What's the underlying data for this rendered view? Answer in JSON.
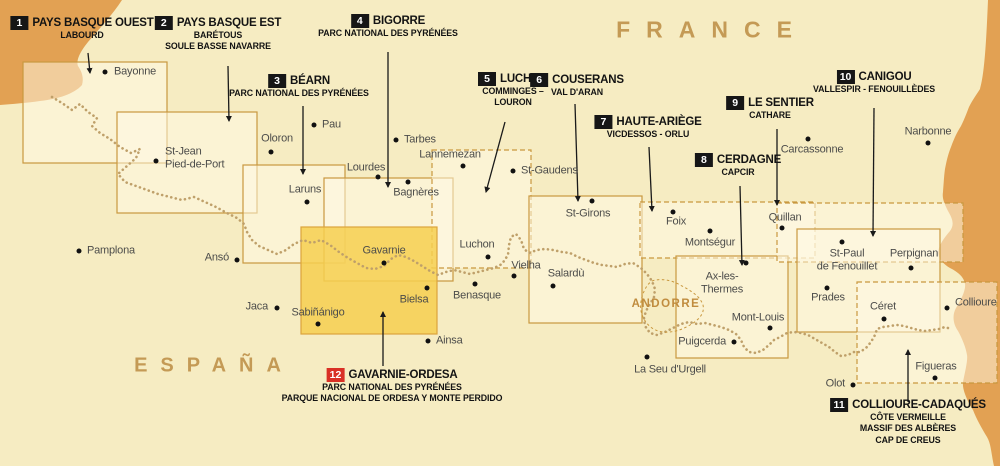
{
  "titles": {
    "france": "FRANCE",
    "espana": "ESPAÑA",
    "andorre": "ANDORRE"
  },
  "colors": {
    "background": "#f6ecc2",
    "sea": "#e2a153",
    "area_border": "#c9983f",
    "area_fill": "rgba(255,250,230,0.5)",
    "highlight_fill": "rgba(246,207,80,0.85)",
    "highlight_border": "#dca43c",
    "trail": "#bfa06a",
    "badge_black": "#161616",
    "badge_red": "#d93025",
    "label_text": "#131313",
    "city_text": "#4c4c4a",
    "region_text": "#c49a55"
  },
  "map_labels": [
    {
      "num": "1",
      "badge": "black",
      "title": "PAYS BASQUE OUEST",
      "subtitle_lines": [
        "LABOURD"
      ],
      "cx": 82,
      "top": 16,
      "arrow": [
        88,
        53,
        90,
        73
      ]
    },
    {
      "num": "2",
      "badge": "black",
      "title": "PAYS BASQUE EST",
      "subtitle_lines": [
        "BARÉTOUS",
        "SOULE BASSE NAVARRE"
      ],
      "cx": 218,
      "top": 16,
      "arrow": [
        228,
        66,
        229,
        121
      ]
    },
    {
      "num": "3",
      "badge": "black",
      "title": "BÉARN",
      "subtitle_lines": [
        "PARC NATIONAL DES PYRÉNÉES"
      ],
      "cx": 299,
      "top": 74,
      "arrow": [
        303,
        106,
        303,
        174
      ]
    },
    {
      "num": "4",
      "badge": "black",
      "title": "BIGORRE",
      "subtitle_lines": [
        "PARC NATIONAL DES PYRÉNÉES"
      ],
      "cx": 388,
      "top": 14,
      "arrow": [
        388,
        52,
        388,
        187
      ]
    },
    {
      "num": "5",
      "badge": "black",
      "title": "LUCHON",
      "subtitle_lines": [
        "COMMINGES –",
        "LOURON"
      ],
      "cx": 513,
      "top": 72,
      "arrow": [
        505,
        122,
        486,
        192
      ]
    },
    {
      "num": "6",
      "badge": "black",
      "title": "COUSERANS",
      "subtitle_lines": [
        "VAL D'ARAN"
      ],
      "cx": 577,
      "top": 73,
      "arrow": [
        575,
        104,
        578,
        201
      ]
    },
    {
      "num": "7",
      "badge": "black",
      "title": "HAUTE-ARIÈGE",
      "subtitle_lines": [
        "VICDESSOS - ORLU"
      ],
      "cx": 648,
      "top": 115,
      "arrow": [
        649,
        147,
        652,
        211
      ]
    },
    {
      "num": "8",
      "badge": "black",
      "title": "CERDAGNE",
      "subtitle_lines": [
        "CAPCIR"
      ],
      "cx": 738,
      "top": 153,
      "arrow": [
        740,
        186,
        742,
        265
      ]
    },
    {
      "num": "9",
      "badge": "black",
      "title": "LE SENTIER",
      "subtitle_lines": [
        "CATHARE"
      ],
      "cx": 770,
      "top": 96,
      "arrow": [
        777,
        129,
        777,
        205
      ]
    },
    {
      "num": "10",
      "badge": "black",
      "title": "CANIGOU",
      "subtitle_lines": [
        "VALLESPIR - FENOUILLÈDES"
      ],
      "cx": 874,
      "top": 70,
      "arrow": [
        874,
        108,
        873,
        236
      ]
    },
    {
      "num": "11",
      "badge": "black",
      "title": "COLLIOURE-CADAQUÉS",
      "subtitle_lines": [
        "CÔTE VERMEILLE",
        "MASSIF DES ALBÈRES",
        "CAP DE CREUS"
      ],
      "cx": 908,
      "top": 398,
      "arrow": [
        908,
        402,
        908,
        350
      ]
    },
    {
      "num": "12",
      "badge": "red",
      "title": "GAVARNIE-ORDESA",
      "subtitle_lines": [
        "PARC NATIONAL DES PYRÉNÉES",
        "PARQUE NACIONAL DE ORDESA Y MONTE PERDIDO"
      ],
      "cx": 392,
      "top": 368,
      "arrow": [
        383,
        366,
        383,
        312
      ]
    }
  ],
  "areas": [
    {
      "map": "1",
      "rect": [
        23,
        62,
        144,
        101
      ],
      "style": "solid"
    },
    {
      "map": "2",
      "rect": [
        117,
        112,
        140,
        101
      ],
      "style": "solid"
    },
    {
      "map": "3",
      "rect": [
        243,
        165,
        102,
        98
      ],
      "style": "solid"
    },
    {
      "map": "4",
      "rect": [
        324,
        178,
        129,
        103
      ],
      "style": "solid"
    },
    {
      "map": "5",
      "rect": [
        432,
        150,
        99,
        118
      ],
      "style": "dashed"
    },
    {
      "map": "6",
      "rect": [
        529,
        196,
        113,
        127
      ],
      "style": "solid"
    },
    {
      "map": "7",
      "rect": [
        640,
        202,
        175,
        56
      ],
      "style": "dashed"
    },
    {
      "map": "8",
      "rect": [
        676,
        256,
        112,
        102
      ],
      "style": "solid"
    },
    {
      "map": "9",
      "rect": [
        777,
        203,
        186,
        59
      ],
      "style": "dashed"
    },
    {
      "map": "10",
      "rect": [
        797,
        229,
        143,
        103
      ],
      "style": "solid"
    },
    {
      "map": "11",
      "rect": [
        857,
        282,
        140,
        101
      ],
      "style": "dashed"
    },
    {
      "map": "12",
      "rect": [
        301,
        227,
        136,
        107
      ],
      "style": "highlight"
    }
  ],
  "cities": [
    {
      "name": "Bayonne",
      "dot": [
        105,
        72
      ],
      "label": [
        114,
        72
      ],
      "anchor": "left"
    },
    {
      "name": "St-Jean\nPied-de-Port",
      "dot": [
        156,
        161
      ],
      "label": [
        165,
        158
      ],
      "anchor": "left"
    },
    {
      "name": "Oloron",
      "dot": [
        271,
        152
      ],
      "label": [
        277,
        139
      ],
      "anchor": "center"
    },
    {
      "name": "Pau",
      "dot": [
        314,
        125
      ],
      "label": [
        322,
        125
      ],
      "anchor": "left"
    },
    {
      "name": "Laruns",
      "dot": [
        307,
        202
      ],
      "label": [
        305,
        190
      ],
      "anchor": "center"
    },
    {
      "name": "Lourdes",
      "dot": [
        378,
        177
      ],
      "label": [
        366,
        168
      ],
      "anchor": "center"
    },
    {
      "name": "Tarbes",
      "dot": [
        396,
        140
      ],
      "label": [
        404,
        140
      ],
      "anchor": "left"
    },
    {
      "name": "Lannemezan",
      "dot": [
        463,
        166
      ],
      "label": [
        450,
        155
      ],
      "anchor": "center"
    },
    {
      "name": "Bagnères",
      "dot": [
        408,
        182
      ],
      "label": [
        416,
        193
      ],
      "anchor": "center"
    },
    {
      "name": "St-Gaudens",
      "dot": [
        513,
        171
      ],
      "label": [
        521,
        171
      ],
      "anchor": "left"
    },
    {
      "name": "St-Girons",
      "dot": [
        592,
        201
      ],
      "label": [
        588,
        214
      ],
      "anchor": "center"
    },
    {
      "name": "Luchon",
      "dot": [
        488,
        257
      ],
      "label": [
        477,
        245
      ],
      "anchor": "center"
    },
    {
      "name": "Vielha",
      "dot": [
        514,
        276
      ],
      "label": [
        526,
        266
      ],
      "anchor": "center"
    },
    {
      "name": "Salardù",
      "dot": [
        553,
        286
      ],
      "label": [
        566,
        274
      ],
      "anchor": "center"
    },
    {
      "name": "Benasque",
      "dot": [
        475,
        284
      ],
      "label": [
        477,
        296
      ],
      "anchor": "center"
    },
    {
      "name": "Gavarnie",
      "dot": [
        384,
        263
      ],
      "label": [
        384,
        251
      ],
      "anchor": "center"
    },
    {
      "name": "Bielsa",
      "dot": [
        427,
        288
      ],
      "label": [
        414,
        300
      ],
      "anchor": "center"
    },
    {
      "name": "Ainsa",
      "dot": [
        428,
        341
      ],
      "label": [
        436,
        341
      ],
      "anchor": "left"
    },
    {
      "name": "Sabiñánigo",
      "dot": [
        318,
        324
      ],
      "label": [
        318,
        313
      ],
      "anchor": "center"
    },
    {
      "name": "Jaca",
      "dot": [
        277,
        308
      ],
      "label": [
        268,
        307
      ],
      "anchor": "right"
    },
    {
      "name": "Ansó",
      "dot": [
        237,
        260
      ],
      "label": [
        229,
        258
      ],
      "anchor": "right"
    },
    {
      "name": "Pamplona",
      "dot": [
        79,
        251
      ],
      "label": [
        87,
        251
      ],
      "anchor": "left"
    },
    {
      "name": "Foix",
      "dot": [
        673,
        212
      ],
      "label": [
        676,
        222
      ],
      "anchor": "center"
    },
    {
      "name": "Montségur",
      "dot": [
        710,
        231
      ],
      "label": [
        710,
        243
      ],
      "anchor": "center"
    },
    {
      "name": "Quillan",
      "dot": [
        782,
        228
      ],
      "label": [
        785,
        218
      ],
      "anchor": "center"
    },
    {
      "name": "Carcassonne",
      "dot": [
        808,
        139
      ],
      "label": [
        812,
        150
      ],
      "anchor": "center"
    },
    {
      "name": "Narbonne",
      "dot": [
        928,
        143
      ],
      "label": [
        928,
        132
      ],
      "anchor": "center"
    },
    {
      "name": "Ax-les-\nThermes",
      "dot": [
        746,
        263
      ],
      "label": [
        722,
        283
      ],
      "anchor": "center"
    },
    {
      "name": "Mont-Louis",
      "dot": [
        770,
        328
      ],
      "label": [
        758,
        318
      ],
      "anchor": "center"
    },
    {
      "name": "Puigcerda",
      "dot": [
        734,
        342
      ],
      "label": [
        726,
        342
      ],
      "anchor": "right"
    },
    {
      "name": "La Seu d'Urgell",
      "dot": [
        647,
        357
      ],
      "label": [
        670,
        370
      ],
      "anchor": "center"
    },
    {
      "name": "Prades",
      "dot": [
        827,
        288
      ],
      "label": [
        828,
        298
      ],
      "anchor": "center"
    },
    {
      "name": "St-Paul\nde Fenouillet",
      "dot": [
        842,
        242
      ],
      "label": [
        847,
        260
      ],
      "anchor": "center"
    },
    {
      "name": "Perpignan",
      "dot": [
        911,
        268
      ],
      "label": [
        914,
        254
      ],
      "anchor": "center"
    },
    {
      "name": "Céret",
      "dot": [
        884,
        319
      ],
      "label": [
        883,
        307
      ],
      "anchor": "center"
    },
    {
      "name": "Collioure",
      "dot": [
        947,
        308
      ],
      "label": [
        955,
        303
      ],
      "anchor": "left"
    },
    {
      "name": "Figueras",
      "dot": [
        935,
        378
      ],
      "label": [
        936,
        367
      ],
      "anchor": "center"
    },
    {
      "name": "Olot",
      "dot": [
        853,
        385
      ],
      "label": [
        845,
        384
      ],
      "anchor": "right"
    }
  ],
  "region_title_positions": {
    "france": {
      "x": 712,
      "y": 30
    },
    "espana": {
      "x": 214,
      "y": 366
    },
    "andorre": {
      "x": 666,
      "y": 304
    }
  }
}
